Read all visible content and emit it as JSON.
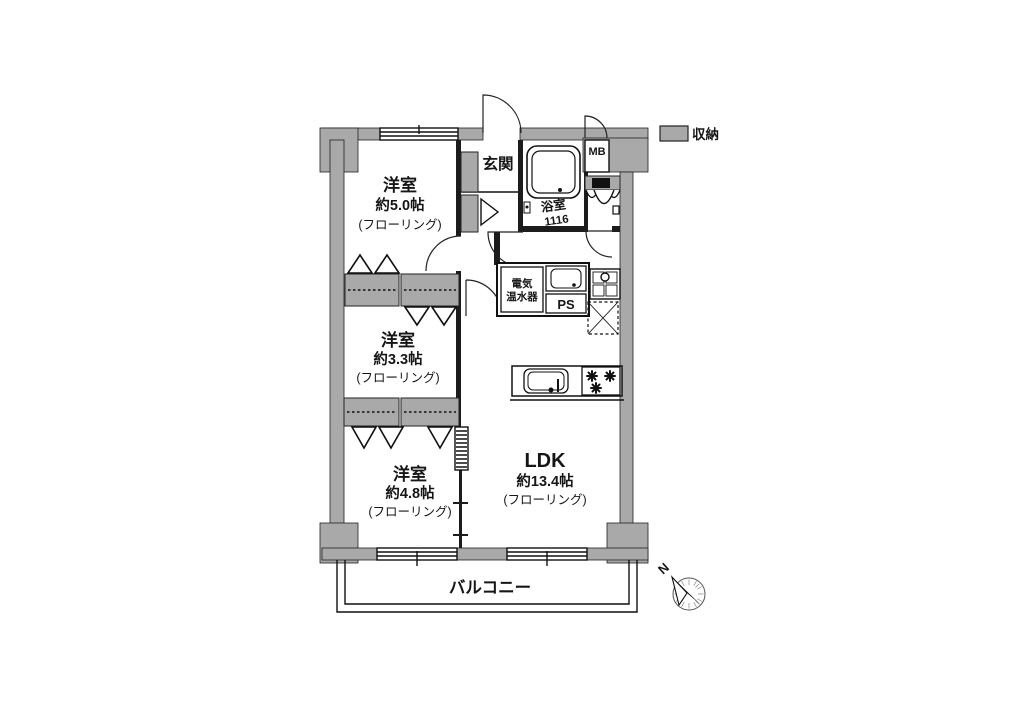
{
  "legend": {
    "storage_label": "収納",
    "swatch_color": "#a9a9a9"
  },
  "plan": {
    "room_5": {
      "name": "洋室",
      "area": "約5.0帖",
      "flooring": "(フローリング)"
    },
    "room_3": {
      "name": "洋室",
      "area": "約3.3帖",
      "flooring": "(フローリング)"
    },
    "room_4": {
      "name": "洋室",
      "area": "約4.8帖",
      "flooring": "(フローリング)"
    },
    "ldk": {
      "name": "LDK",
      "area": "約13.4帖",
      "flooring": "(フローリング)"
    },
    "genkan_label": "玄関",
    "bath_label": "浴室",
    "bath_size": "1116",
    "mb_label": "MB",
    "heater_line1": "電気",
    "heater_line2": "温水器",
    "ps_label": "PS",
    "balcony_label": "バルコニー",
    "compass_n": "N"
  },
  "colors": {
    "wall": "#a9a9a9",
    "line": "#1a1a1a",
    "background": "#ffffff"
  }
}
